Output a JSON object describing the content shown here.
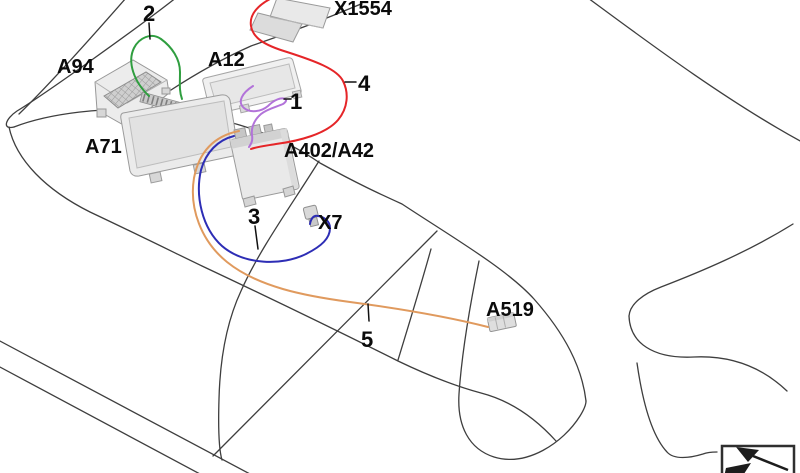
{
  "diagram": {
    "title": "vehicle-wiring-harness-routing-diagram",
    "components": [
      {
        "id": "X1554",
        "label": "X1554"
      },
      {
        "id": "A94",
        "label": "A94"
      },
      {
        "id": "A12",
        "label": "A12"
      },
      {
        "id": "A71",
        "label": "A71"
      },
      {
        "id": "A402",
        "label": "A402/A42"
      },
      {
        "id": "X7",
        "label": "X7"
      },
      {
        "id": "A519",
        "label": "A519"
      }
    ],
    "callouts": [
      {
        "number": "1",
        "wire_color": "#b273d9"
      },
      {
        "number": "2",
        "wire_color": "#2f9e3f"
      },
      {
        "number": "3",
        "wire_color": "#2d2db5"
      },
      {
        "number": "4",
        "wire_color": "#e52528"
      },
      {
        "number": "5",
        "wire_color": "#e09a5e"
      }
    ],
    "outline_color": "#3e3e3e",
    "icon": {
      "name": "direction-of-travel-icon"
    }
  }
}
